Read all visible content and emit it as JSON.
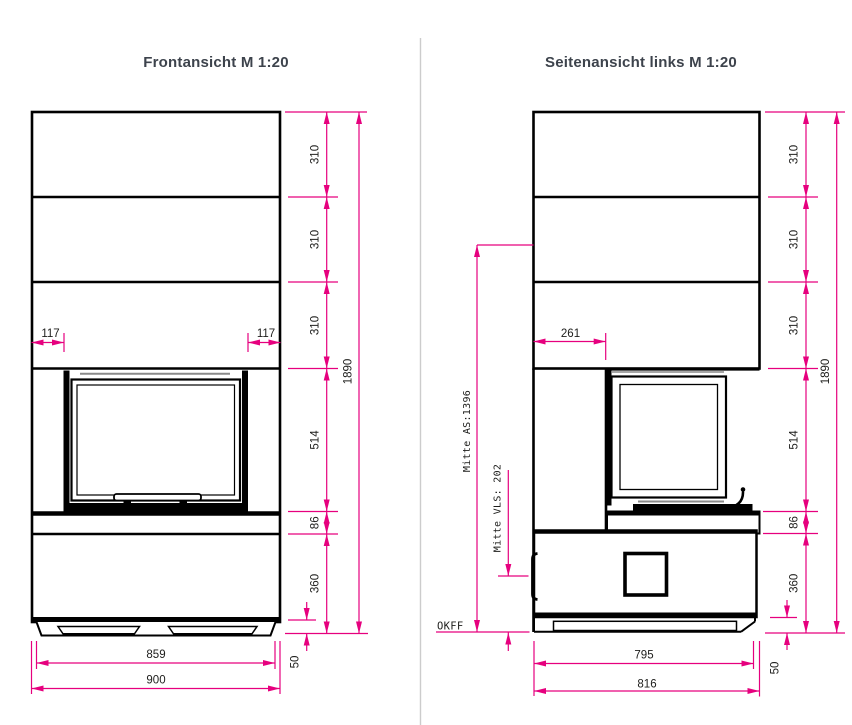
{
  "page": {
    "background": "#ffffff",
    "divider_color": "#cccccc"
  },
  "colors": {
    "dimension_lines": "#e6007e",
    "drawing_lines": "#000000",
    "title_text": "#3d434c",
    "dimension_text": "#1d1d1b"
  },
  "front_view": {
    "title": "Frontansicht M 1:20",
    "dims": {
      "chain": [
        "310",
        "310",
        "310",
        "514",
        "86",
        "360"
      ],
      "overall_height": "1890",
      "left_offset": "117",
      "right_offset": "117",
      "inner_width": "859",
      "outer_width": "900",
      "plinth_height": "50"
    }
  },
  "side_view": {
    "title": "Seitenansicht links M 1:20",
    "dims": {
      "chain": [
        "310",
        "310",
        "310",
        "514",
        "86",
        "360"
      ],
      "overall_height": "1890",
      "top_depth": "261",
      "inner_depth": "795",
      "outer_depth": "816",
      "plinth_height": "50",
      "flue_center": "Mitte AS:1396",
      "air_center": "Mitte VLS: 202",
      "floor_label": "OKFF"
    }
  }
}
